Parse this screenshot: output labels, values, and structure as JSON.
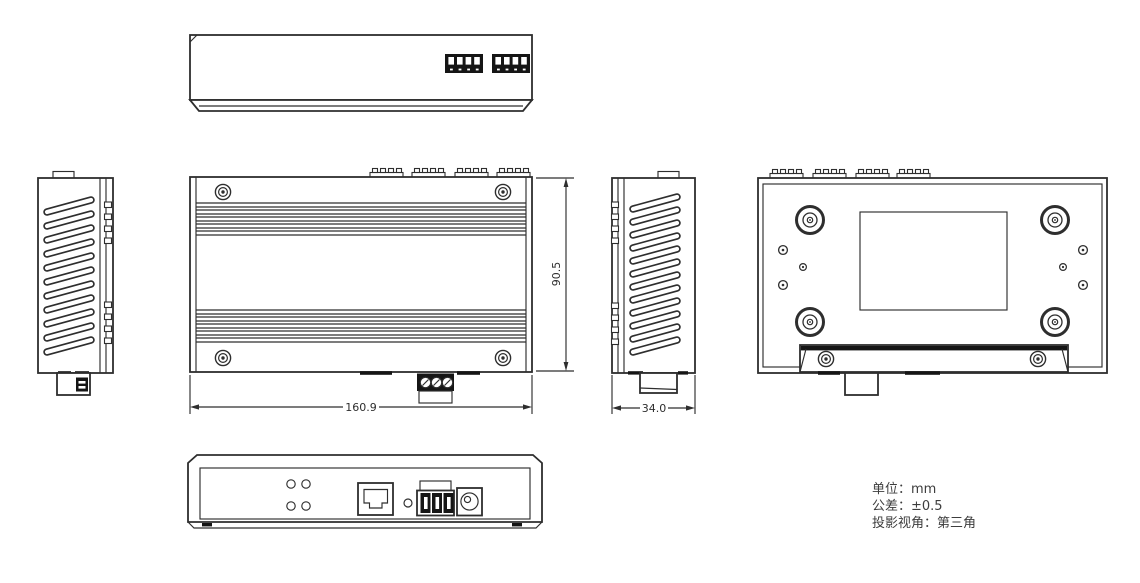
{
  "drawing": {
    "background": "#ffffff",
    "line_color": "#2e2e2e",
    "dark_fill": "#151515"
  },
  "dimensions": {
    "overall_width": "160.9",
    "overall_height": "90.5",
    "overall_depth": "34.0"
  },
  "notes": {
    "unit": "单位：mm",
    "tolerance": "公差：±0.5",
    "projection": "投影视角：第三角"
  }
}
